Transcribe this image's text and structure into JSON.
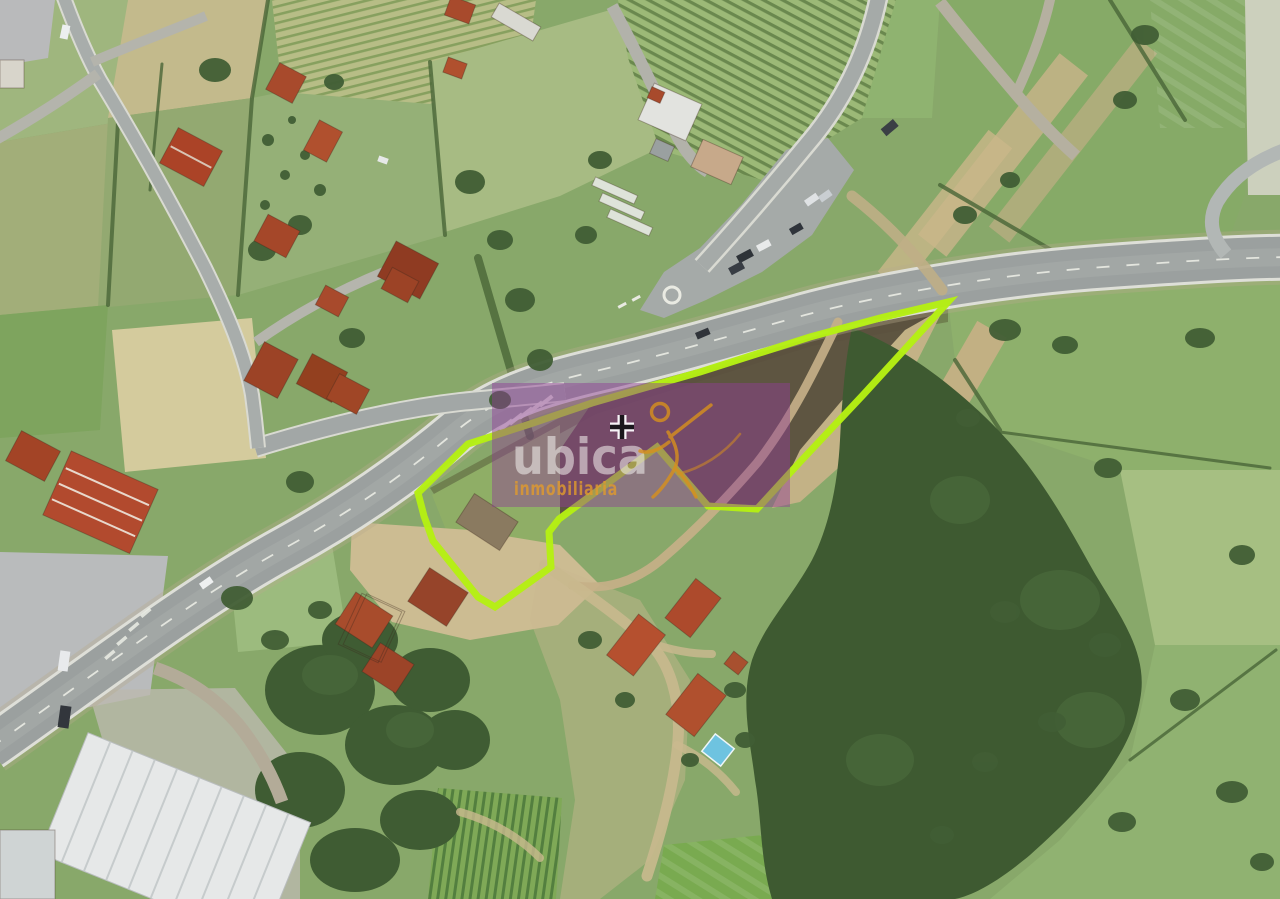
{
  "app": {
    "type": "aerial-property-listing-image"
  },
  "watermark": {
    "brand": "ubica",
    "tagline": "inmobiliaria",
    "brand_color": "rgba(244,242,238,0.55)",
    "tagline_color": "#e09a2e",
    "tagline_opacity": 0.82,
    "overlay_color": "#8f3d96",
    "overlay_opacity": 0.46,
    "figure_icon": "running-person-icon",
    "rect": {
      "x": 492,
      "y": 383,
      "w": 298,
      "h": 124
    }
  },
  "parcel": {
    "outline_color": "#b5ef13",
    "stroke_width": 7,
    "points": "418,493 468,444 530,424 592,403 700,372 810,337 880,318 948,302 863,395 800,462 757,509 708,506 657,447 559,519 549,532 551,567 495,607 478,597 433,541 424,516"
  },
  "marker": {
    "x": 622,
    "y": 427,
    "transform": "translate(622 427)",
    "color": "#1a171c",
    "halo_color": "#f7f3f7"
  },
  "scene": {
    "features": [
      "farm-fields",
      "vineyard-rows",
      "highway",
      "junction-parking",
      "rural-roads",
      "dirt-tracks",
      "forest",
      "houses",
      "industrial-warehouse",
      "swimming-pool",
      "parked-cars"
    ]
  }
}
